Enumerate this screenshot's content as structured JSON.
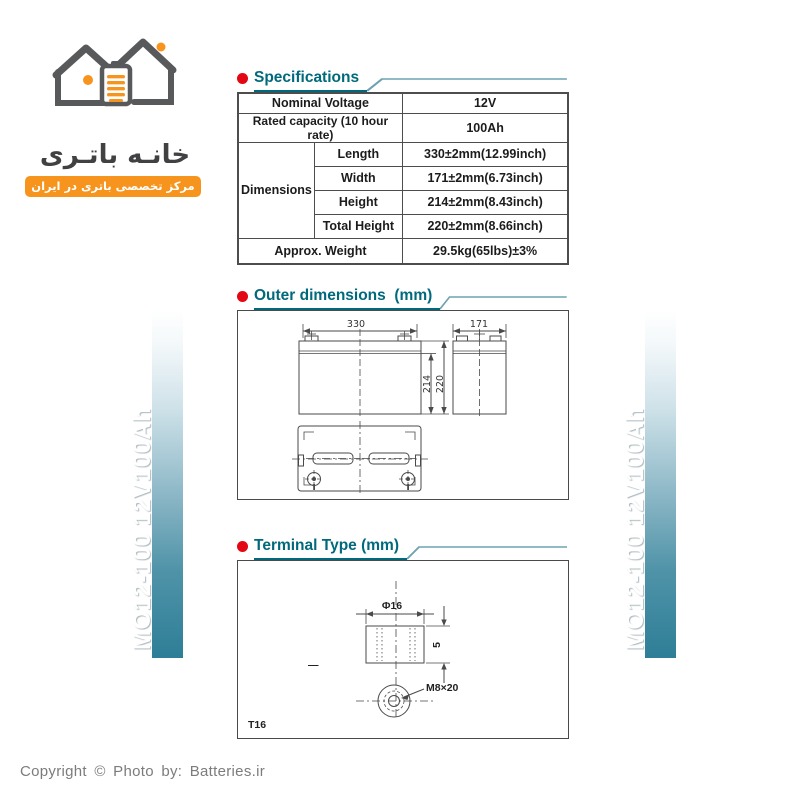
{
  "logo": {
    "brand_fa": "خانـه باتـری",
    "tagline_fa": "مرکز تخصصی باتری در ایران",
    "orange": "#F7941E",
    "gray": "#58595B"
  },
  "sidebar": {
    "label": "MO12-100  12V100Ah",
    "teal": "#2E7E97"
  },
  "sections": {
    "specifications": "Specifications",
    "outer_dimensions": "Outer dimensions  (mm)",
    "terminal_type": "Terminal Type (mm)"
  },
  "spec_table": {
    "rows_simple": [
      {
        "label": "Nominal Voltage",
        "value": "12V"
      },
      {
        "label": "Rated capacity (10 hour rate)",
        "value": "100Ah"
      }
    ],
    "dimensions_label": "Dimensions",
    "dimension_rows": [
      {
        "label": "Length",
        "value": "330±2mm(12.99inch)"
      },
      {
        "label": "Width",
        "value": "171±2mm(6.73inch)"
      },
      {
        "label": "Height",
        "value": "214±2mm(8.43inch)"
      },
      {
        "label": "Total Height",
        "value": "220±2mm(8.66inch)"
      }
    ],
    "weight_row": {
      "label": "Approx. Weight",
      "value": "29.5kg(65lbs)±3%"
    }
  },
  "outer_drawing": {
    "front_width": "330",
    "side_width": "171",
    "body_height": "214",
    "total_height": "220"
  },
  "terminal_drawing": {
    "diameter": "Φ16",
    "nut_height": "5",
    "stud": "M8×20",
    "terminal_code": "T16",
    "minus_mark": "—"
  },
  "footer": {
    "copyright": "Copyright  © Photo by:  Batteries.ir"
  },
  "accent": {
    "teal_dark": "#00697C",
    "teal_line": "#6FA3B2",
    "red": "#E30613"
  }
}
